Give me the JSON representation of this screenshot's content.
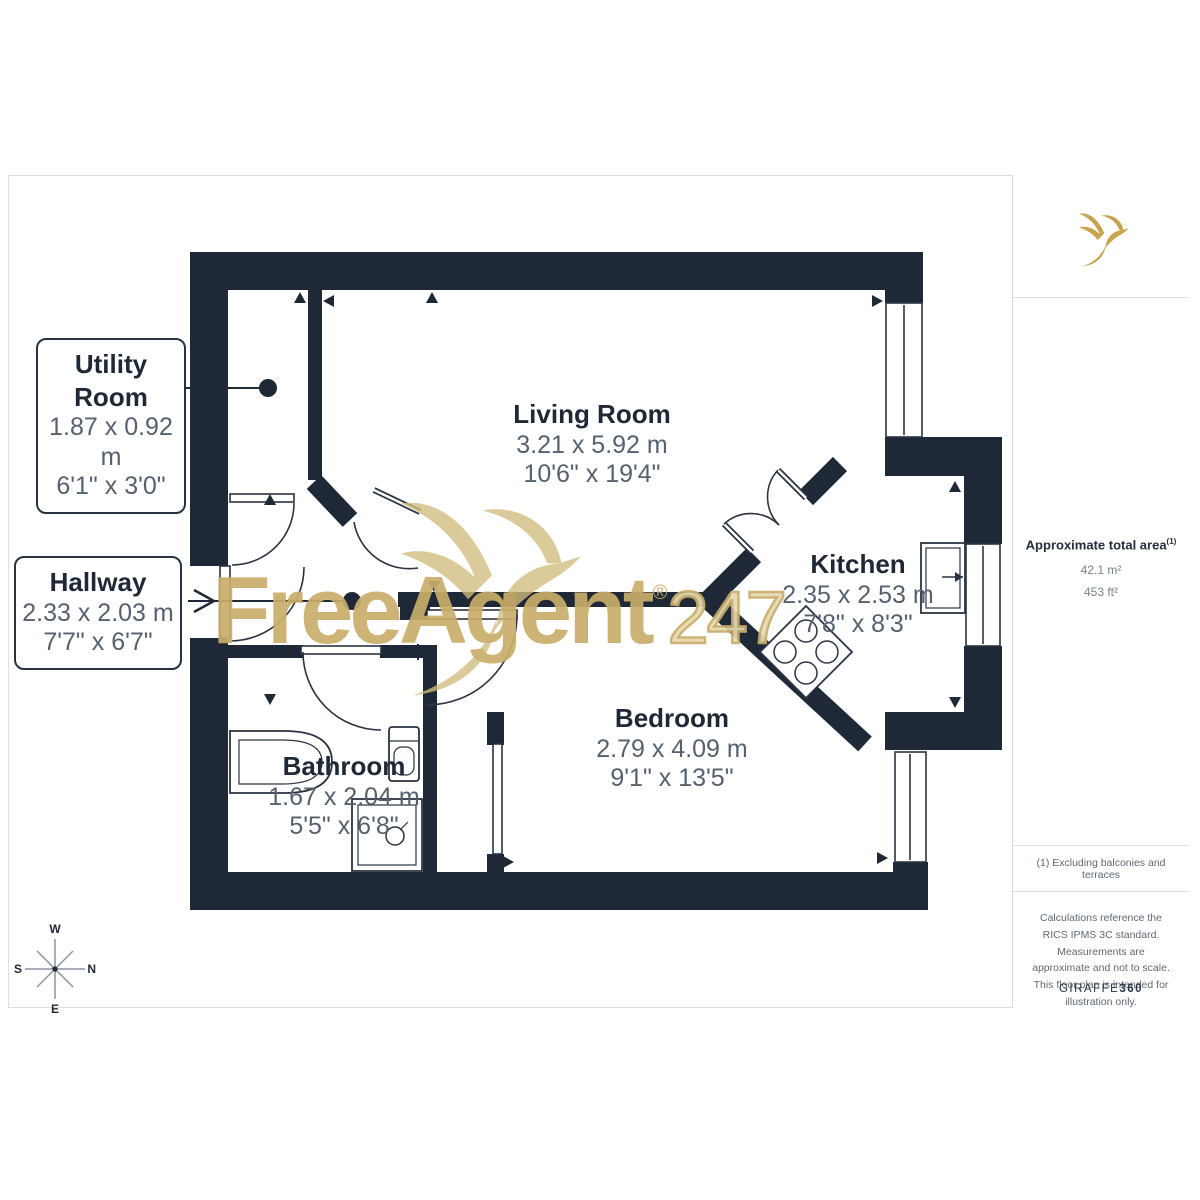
{
  "watermark": {
    "brand": "FreeAgent",
    "suffix": "247",
    "registered": "®"
  },
  "sidebar": {
    "area_label": "Approximate total area",
    "area_superscript": "(1)",
    "area_m2": "42.1 m²",
    "area_ft2": "453 ft²",
    "footnote": "(1) Excluding balconies and terraces",
    "legal": "Calculations reference the RICS IPMS 3C standard. Measurements are approximate and not to scale. This floor plan is intended for illustration only.",
    "brand_name": "GIRAFFE",
    "brand_number": "360"
  },
  "rooms": [
    {
      "name": "Utility Room",
      "metric": "1.87 x 0.92 m",
      "imperial": "6'1\" x 3'0\""
    },
    {
      "name": "Hallway",
      "metric": "2.33 x 2.03 m",
      "imperial": "7'7\" x 6'7\""
    },
    {
      "name": "Living Room",
      "metric": "3.21 x 5.92 m",
      "imperial": "10'6\" x 19'4\""
    },
    {
      "name": "Kitchen",
      "metric": "2.35 x 2.53 m",
      "imperial": "7'8\" x 8'3\""
    },
    {
      "name": "Bedroom",
      "metric": "2.79 x 4.09 m",
      "imperial": "9'1\" x 13'5\""
    },
    {
      "name": "Bathroom",
      "metric": "1.67 x 2.04 m",
      "imperial": "5'5\" x 6'8\""
    }
  ],
  "compass": {
    "north": "N",
    "south": "S",
    "east": "E",
    "west": "W"
  },
  "colors": {
    "wall": "#1F2836",
    "dim_text": "#56616F",
    "brand_gold": "#C8A34E",
    "watermark_gold": "#C9AE6B"
  }
}
